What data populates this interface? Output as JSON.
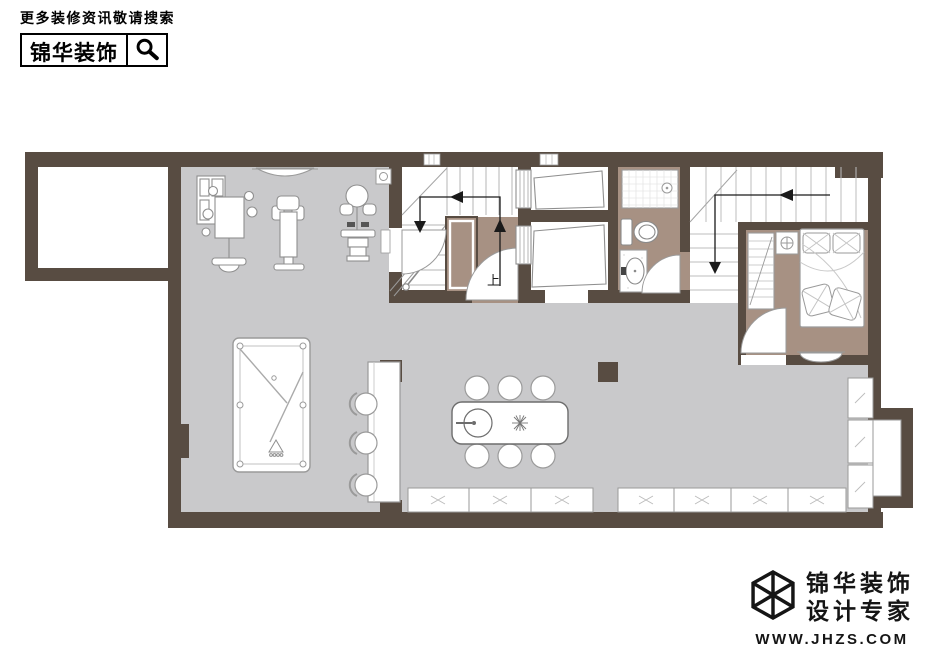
{
  "header": {
    "tagline": "更多装修资讯敬请搜索",
    "brand": "锦华装饰",
    "search_icon": "magnifier-icon"
  },
  "floor_plan": {
    "stair_up_label": "上",
    "colors": {
      "wall": "#584c42",
      "floor_gray": "#c9c9cb",
      "floor_taupe": "#a79183",
      "furniture_line": "#8f8f8f",
      "arrow": "#1a1a1a"
    }
  },
  "footer": {
    "brand_top": "锦华装饰",
    "brand_bottom": "设计专家",
    "website": "WWW.JHZS.COM",
    "logo_icon": "cube-wireframe-icon"
  }
}
